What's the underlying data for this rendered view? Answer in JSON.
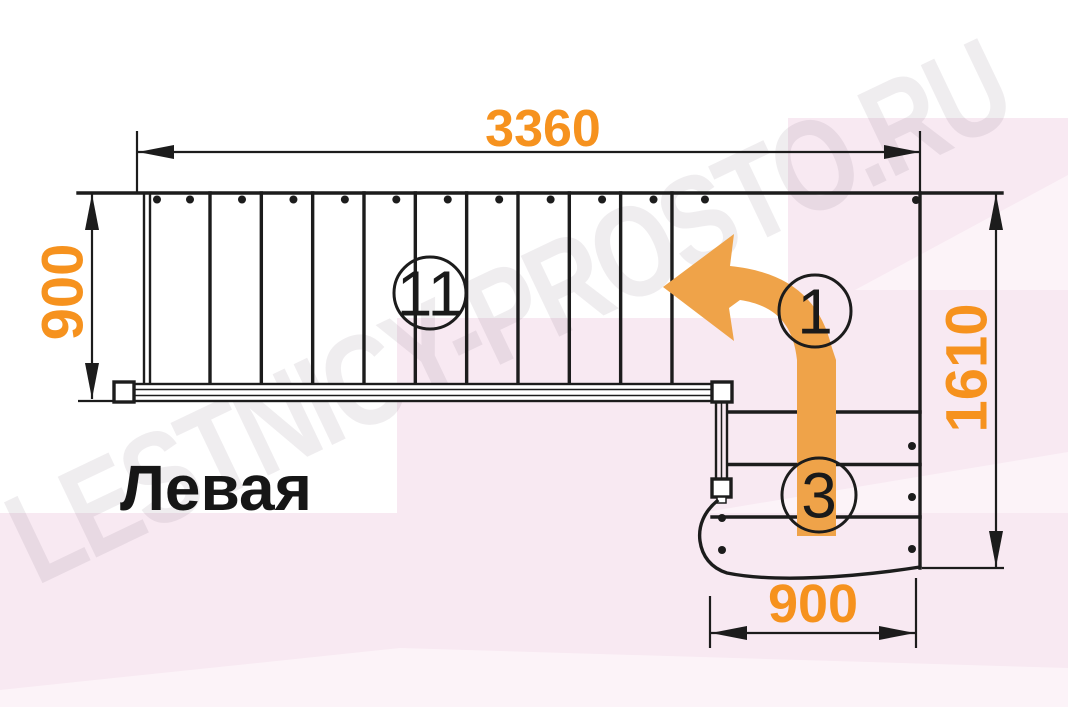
{
  "title": "Левая",
  "watermark": "LESTNICY-PROSTO.RU",
  "dimensions": {
    "top": "3360",
    "left": "900",
    "right": "1610",
    "bottom": "900"
  },
  "badges": {
    "top_flight_steps": "11",
    "turn_point": "1",
    "bottom_flight_steps": "3"
  },
  "diagram": {
    "top_flight": {
      "steps": 11
    },
    "bottom_flight": {
      "steps": 3
    },
    "direction": "up, turning left"
  },
  "colors": {
    "dimension_orange": "#F6921E",
    "arrow_orange": "#EFA349",
    "line_dark": "#1C1C1C",
    "bg_pink": "#F8E9F2",
    "bg_pink_light": "#FCF3F8",
    "watermark_gray": "rgba(95,75,95,0.10)"
  }
}
